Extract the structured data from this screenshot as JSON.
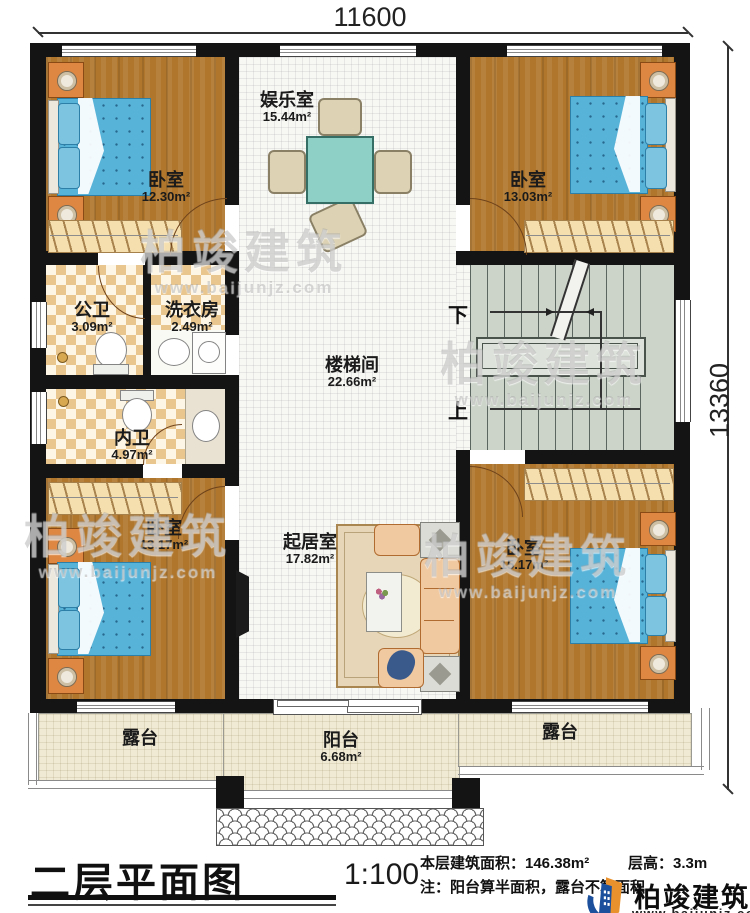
{
  "dims": {
    "top": "11600",
    "right": "13360"
  },
  "rooms": {
    "bedroom_tl": {
      "name": "卧室",
      "area": "12.30m²"
    },
    "entertainment": {
      "name": "娱乐室",
      "area": "15.44m²"
    },
    "bedroom_tr": {
      "name": "卧室",
      "area": "13.03m²"
    },
    "public_bath": {
      "name": "公卫",
      "area": "3.09m²"
    },
    "laundry": {
      "name": "洗衣房",
      "area": "2.49m²"
    },
    "inner_bath": {
      "name": "内卫",
      "area": "4.97m²"
    },
    "stair_hall": {
      "name": "楼梯间",
      "area": "22.66m²"
    },
    "bedroom_bl": {
      "name": "卧室",
      "area": "13.17m²"
    },
    "living": {
      "name": "起居室",
      "area": "17.82m²"
    },
    "bedroom_br": {
      "name": "卧室",
      "area": "15.17m²"
    },
    "terrace_left": {
      "name": "露台"
    },
    "balcony": {
      "name": "阳台",
      "area": "6.68m²"
    },
    "terrace_right": {
      "name": "露台"
    }
  },
  "stairs": {
    "down": "下",
    "up": "上"
  },
  "titleblock": {
    "title": "二层平面图",
    "scale": "1:100",
    "area_label": "本层建筑面积：146.38m²",
    "floor_height": "层高：3.3m",
    "note": "注：阳台算半面积，露台不算面积"
  },
  "logo": {
    "name": "柏竣建筑",
    "url": "www.baijunjz.com"
  },
  "watermark": {
    "name": "柏竣建筑",
    "url": "www.baijunjz.com"
  }
}
